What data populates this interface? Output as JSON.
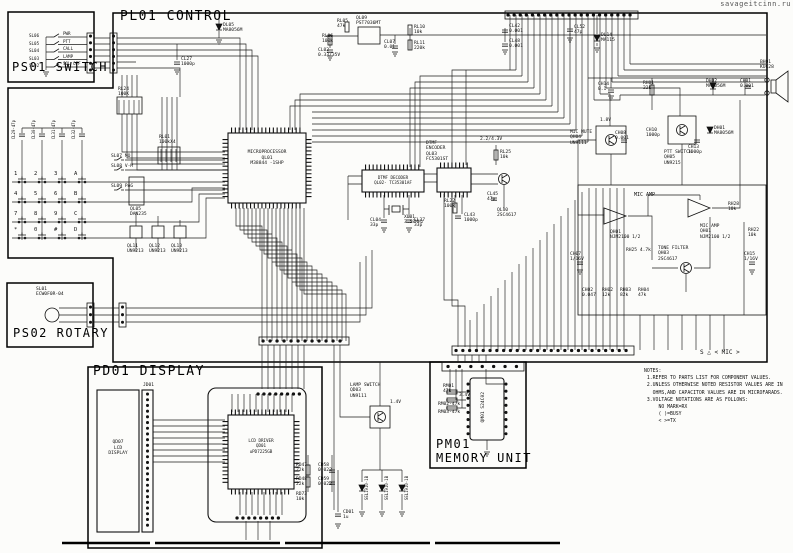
{
  "watermark": "savageitcinn.ru",
  "titles": {
    "ps01": "PS01 SWITCH",
    "pl01": "PL01 CONTROL",
    "ps02": "PS02 ROTARY",
    "pd01": "PD01 DISPLAY",
    "pm01": "PM01\nMEMORY UNIT"
  },
  "ps01_switches": [
    {
      "ref": "SL06",
      "name": "PWR"
    },
    {
      "ref": "SL05",
      "name": "PTT"
    },
    {
      "ref": "SL04",
      "name": "CALL"
    },
    {
      "ref": "SL03",
      "name": "LAMP"
    },
    {
      "ref": "SL02",
      "name": "SQL OFF"
    }
  ],
  "keypad_keys": [
    "1",
    "2",
    "3",
    "A",
    "4",
    "5",
    "6",
    "B",
    "7",
    "8",
    "9",
    "C",
    "*",
    "0",
    "#",
    "D"
  ],
  "ics": {
    "cpu": "MICROPROCESSOR\nQL01\nM38844 -1SHP",
    "dtmf_decoder": "DTMF DECODER\nQL02- TC35301AF",
    "dtmf_encoder": "DTMF\nENCODER\nQL03\nFC5301ST",
    "lcd_driver": "LCD DRIVER\nQD01\nuPD7225GB",
    "lcd": "QD07\nLCD\nDISPLAY",
    "eeprom": "QM01 S24C02",
    "rotary": "SL01\nECW0F0R-04"
  },
  "labels": {
    "rl05": "RL05\n47k",
    "rl06": "RL06\n100k",
    "cl02": "CL02\n0.33/35V",
    "ql09": "QL09\nPST7036MT",
    "cl07": "CL07\n0.01",
    "rl10": "RL10\n10k",
    "rl11": "RL11\n220k",
    "cl42": "CL42\n0.001",
    "cl48": "CL48\n0.001",
    "cl52": "CL52\n47p",
    "dl14": "DL14\nMA115",
    "dl05": "DL05\nMA8056M",
    "cl27": "CL27\n1000p",
    "rl24": "RL24\n100K",
    "rl01": "RL01\n100kX4",
    "sl07": "SL07  MO",
    "sl08": "SL08  V-M",
    "sl09": "SL09  PAG",
    "ql05": "QL05\nDAN235",
    "ql11": "QL11\nUN9213",
    "ql12": "QL12\nUN9213",
    "ql13": "QL13\nUN9213",
    "kc1": "CL29-47p",
    "kc2": "CL30-47p",
    "kc3": "CL31-47p",
    "kc4": "CL32-47p",
    "xl01": "XL01\n3.58MHz",
    "cl04": "CL04\n33p",
    "cl37": "CL37\n33p",
    "rl22": "RL22\n100k",
    "cl43": "CL43\n1000p",
    "rl25": "RL25\n10k",
    "cl45": "CL45\n47p",
    "ql10": "QL10\n2SC4617",
    "mic_amp": "MIC AMP",
    "qh01a": "QH01\nNJM2100 1/2",
    "qh01b": "MIC AMP\nQH01\nNJM2100 1/2",
    "tone_filter": "TONE FILTER\nQH03\n2SC4617",
    "mic_mute": "MIC MUTE\nQH04\nUN9111",
    "ptt_switch": "PTT SWITCH\nQH05\nUN9215",
    "rh01": "RH01\n22k",
    "dh02": "DH02\nMA8056M",
    "ch01": "CH01\n0.001",
    "dh01": "DH01\nMA8056M",
    "ch13": "CH13\n1000p",
    "bh01": "BH01\nKUC28",
    "ch14": "CH14\n0.1",
    "ch08": "CH08\n0.001",
    "ch10": "CH10\n1000p",
    "rh28": "RH28\n10k",
    "rh22": "RH22\n10k",
    "ch15": "CH15\n1/16V",
    "ch07": "CH07\n1/16V",
    "rh25": "RH25 4.7k",
    "ch02": "CH02\n0.047",
    "rh02": "RH02\n12k",
    "rh03": "RH03\n82k",
    "rh04": "RH04\n47k",
    "lamp_switch": "LAMP SWITCH\nQD03\nUN9111",
    "jd01": "JD01",
    "rm01": "RM01\n47k",
    "rm02": "RM02-47k",
    "rm03": "RM03-47k",
    "rd47": "RD47\n22k",
    "rd48": "RD48\n22k",
    "cd58": "CD58\n0.022",
    "cd59": "CD59\n0.022",
    "cd01": "CD01\n1u",
    "rd73": "RD73\n10k",
    "led": "SEL1910-1B"
  },
  "annotations": {
    "sheet": "S △ < MIC >",
    "v14": "1.4V",
    "v18": "1.8V",
    "v34": "3.4V",
    "v2243": "2.2/4.3V"
  },
  "notes": {
    "text": "NOTES:\n 1.REFER TO PARTS LIST FOR COMPONENT VALUES.\n 2.UNLESS OTHERWISE NOTED RESISTOR VALUES ARE IN\n   OHMS,AND CAPACITOR VALUES ARE IN MICROFARADS.\n 3.VOLTAGE NOTATIONS ARE AS FOLLOWS:\n     NO MARK=RX\n     ( )=BUSY\n     < >=TX"
  }
}
